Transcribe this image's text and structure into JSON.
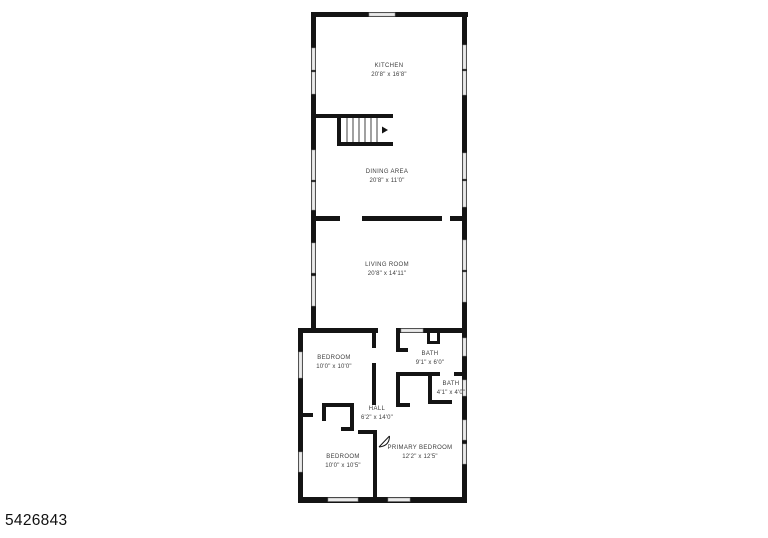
{
  "plan": {
    "listing_number": "5426843",
    "rooms": {
      "kitchen": {
        "name": "KITCHEN",
        "dims": "20'8\" x 16'8\""
      },
      "dining_area": {
        "name": "DINING AREA",
        "dims": "20'8\" x 11'0\""
      },
      "living_room": {
        "name": "LIVING ROOM",
        "dims": "20'8\" x 14'11\""
      },
      "bedroom_top": {
        "name": "BEDROOM",
        "dims": "10'0\" x 10'0\""
      },
      "bath_main": {
        "name": "BATH",
        "dims": "9'1\" x 6'0\""
      },
      "bath_small": {
        "name": "BATH",
        "dims": "4'1\" x 4'0\""
      },
      "hall": {
        "name": "HALL",
        "dims": "6'2\" x 14'0\""
      },
      "bedroom_bottom": {
        "name": "BEDROOM",
        "dims": "10'0\" x 10'5\""
      },
      "primary_bedroom": {
        "name": "PRIMARY BEDROOM",
        "dims": "12'2\" x 12'5\""
      }
    },
    "colors": {
      "wall": "#141414",
      "window_fill": "#ebebeb",
      "window_stroke": "#8f8f8f",
      "label_text": "#3d3d3d",
      "background": "#ffffff"
    }
  }
}
